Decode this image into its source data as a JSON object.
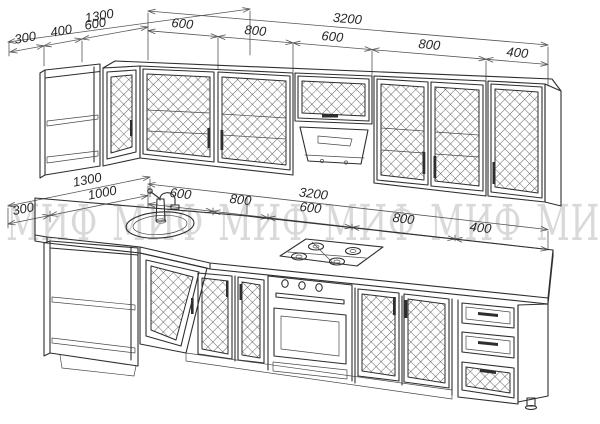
{
  "watermark": {
    "text": "МИФ"
  },
  "colors": {
    "line": "#2e2e2e",
    "dimension_text": "#262626",
    "watermark": "#d9d9d9",
    "background": "#ffffff"
  },
  "upper_view": {
    "depth_chain": {
      "total": "1300",
      "segments": [
        "300",
        "400",
        "600"
      ]
    },
    "width_chain": {
      "total": "3200",
      "segments": [
        "600",
        "800",
        "600",
        "800",
        "400"
      ]
    }
  },
  "lower_view": {
    "depth_chain": {
      "total": "1300",
      "segments": [
        "300",
        "1000"
      ]
    },
    "width_chain": {
      "total": "3200",
      "segments": [
        "600",
        "800",
        "600",
        "800",
        "400"
      ]
    }
  }
}
